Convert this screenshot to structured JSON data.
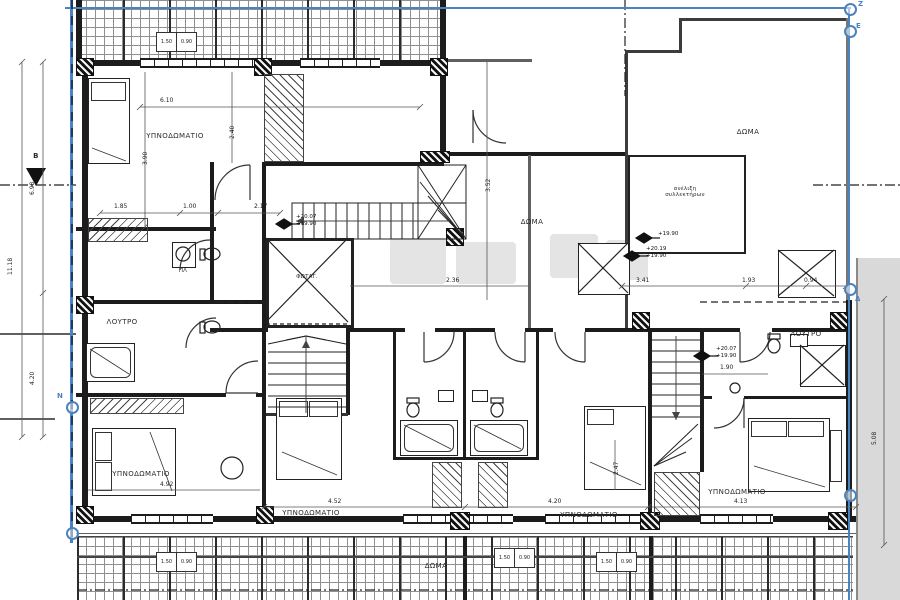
{
  "drawing": {
    "rooms": {
      "bedroom_top_left": "ΥΠΝΟΔΩΜΑΤΙΟ",
      "bedroom_bottom_left": "ΥΠΝΟΔΩΜΑΤΙΟ",
      "bedroom_bottom_center": "ΥΠΝΟΔΩΜΑΤΙΟ",
      "bedroom_bottom_mid_right": "ΥΠΝΟΔΩΜΑΤΙΟ",
      "bedroom_bottom_right": "ΥΠΝΟΔΩΜΑΤΙΟ",
      "bath_left": "ΛΟΥΤΡΟ",
      "bath_right": "ΛΟΥΤΡΟ",
      "roof_terrace_top_right": "ΔΩΜΑ",
      "roof_terrace_center": "ΔΩΜΑ",
      "roof_terrace_bottom": "ΔΩΜΑ",
      "light_well": "ΦΩΤΑΓ.",
      "washing_machine": "ΠΛ",
      "collector_line1": "ανέλιξη",
      "collector_line2": "συλλεκτήρων"
    },
    "elevations": {
      "m1a": "+20.07",
      "m1b": "+19.90",
      "m2": "+19.90",
      "m3a": "+20.19",
      "m3b": "+19.90",
      "m4a": "+20.07",
      "m4b": "+19.90"
    },
    "boundary_markers": {
      "z": "Z",
      "e": "E",
      "delta": "Δ",
      "n": "N"
    },
    "section_label": "B",
    "cells": {
      "a": "1.50",
      "b": "0.90"
    },
    "dim_labels": [
      {
        "t": "6.10",
        "x": 160,
        "y": 97
      },
      {
        "t": "2.40",
        "x": 236,
        "y": 132,
        "r": 1
      },
      {
        "t": "3.90",
        "x": 149,
        "y": 158,
        "r": 1
      },
      {
        "t": "1.85",
        "x": 114,
        "y": 203
      },
      {
        "t": "1.00",
        "x": 183,
        "y": 203
      },
      {
        "t": "2.17",
        "x": 254,
        "y": 203
      },
      {
        "t": "3.52",
        "x": 492,
        "y": 185,
        "r": 1
      },
      {
        "t": "2.36",
        "x": 446,
        "y": 277
      },
      {
        "t": "3.41",
        "x": 636,
        "y": 277
      },
      {
        "t": "1.93",
        "x": 742,
        "y": 277
      },
      {
        "t": "0.94",
        "x": 804,
        "y": 277
      },
      {
        "t": "4.92",
        "x": 160,
        "y": 481
      },
      {
        "t": "4.52",
        "x": 328,
        "y": 498
      },
      {
        "t": "4.20",
        "x": 548,
        "y": 498
      },
      {
        "t": "4.13",
        "x": 734,
        "y": 498
      },
      {
        "t": "1.90",
        "x": 720,
        "y": 364
      },
      {
        "t": "2.47",
        "x": 620,
        "y": 468,
        "r": 1
      },
      {
        "t": "11.18",
        "x": 14,
        "y": 268,
        "r": 1
      },
      {
        "t": "6.98",
        "x": 36,
        "y": 188,
        "r": 1
      },
      {
        "t": "4.20",
        "x": 36,
        "y": 378,
        "r": 1
      },
      {
        "t": "5.08",
        "x": 878,
        "y": 438,
        "r": 1
      }
    ]
  }
}
